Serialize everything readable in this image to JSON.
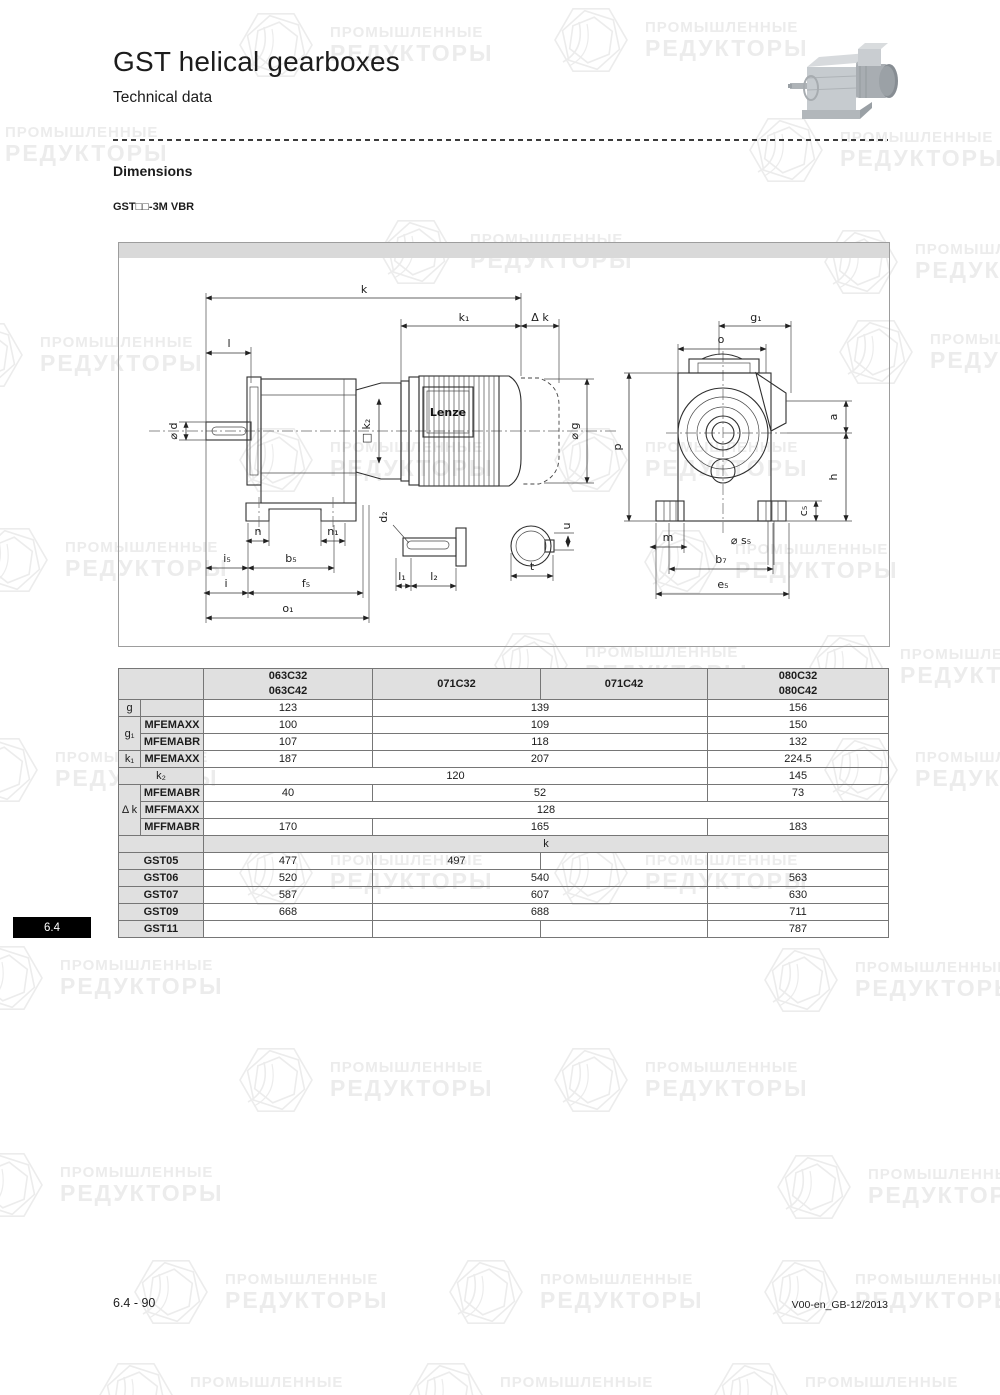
{
  "page": {
    "title": "GST helical gearboxes",
    "subtitle": "Technical data",
    "section_heading": "Dimensions",
    "variant_label": "GST□□-3M VBR",
    "tab_label": "6.4",
    "footer_left": "6.4 - 90",
    "footer_right": "V00-en_GB-12/2013"
  },
  "watermark": {
    "line1": "ПРОМЫШЛЕННЫЕ",
    "line2": "РЕДУКТОРЫ",
    "color": "#ececec"
  },
  "drawing": {
    "brand": "Lenze",
    "labels": {
      "k": "k",
      "k1": "k₁",
      "dk": "Δ k",
      "l": "l",
      "d": "⌀ d",
      "k2": "□ k₂",
      "g": "⌀ g",
      "n": "n",
      "n1": "n₁",
      "i5": "i₅",
      "b5": "b₅",
      "i": "i",
      "f5": "f₅",
      "o1": "o₁",
      "d2": "d₂",
      "l1": "l₁",
      "l2": "l₂",
      "t": "t",
      "u": "u",
      "g1": "g₁",
      "o": "o",
      "p": "p",
      "a": "a",
      "h": "h",
      "c5": "c₅",
      "m": "m",
      "s5": "⌀ s₅",
      "b7": "b₇",
      "e5": "e₅"
    }
  },
  "table": {
    "col_headers": {
      "c1a": "063C32",
      "c1b": "063C42",
      "c2": "071C32",
      "c3": "071C42",
      "c4a": "080C32",
      "c4b": "080C42"
    },
    "rows": {
      "g": {
        "label": "g",
        "sub": "",
        "v1": "123",
        "v23": "139",
        "v4": "156"
      },
      "g1": {
        "label": "g₁"
      },
      "g1_maxx": {
        "sub": "MFEMAXX",
        "v1": "100",
        "v23": "109",
        "v4": "150"
      },
      "g1_mabr": {
        "sub": "MFEMABR",
        "v1": "107",
        "v23": "118",
        "v4": "132"
      },
      "k1": {
        "label": "k₁",
        "sub": "MFEMAXX",
        "v1": "187",
        "v23": "207",
        "v4": "224.5"
      },
      "k2": {
        "label": "k₂",
        "v123": "120",
        "v4": "145"
      },
      "dk": {
        "label": "Δ k"
      },
      "dk_mabr": {
        "sub": "MFEMABR",
        "v1": "40",
        "v23": "52",
        "v4": "73"
      },
      "dk_fmaxx": {
        "sub": "MFFMAXX",
        "v1234": "128"
      },
      "dk_fmabr": {
        "sub": "MFFMABR",
        "v1": "170",
        "v23": "165",
        "v4": "183"
      },
      "k_section": {
        "label": "k"
      },
      "gst05": {
        "label": "GST05",
        "v1": "477",
        "v2": "497",
        "v3": "",
        "v4": ""
      },
      "gst06": {
        "label": "GST06",
        "v1": "520",
        "v23": "540",
        "v4": "563"
      },
      "gst07": {
        "label": "GST07",
        "v1": "587",
        "v23": "607",
        "v4": "630"
      },
      "gst09": {
        "label": "GST09",
        "v1": "668",
        "v23": "688",
        "v4": "711"
      },
      "gst11": {
        "label": "GST11",
        "v1": "",
        "v2": "",
        "v3": "",
        "v4": "787"
      }
    }
  }
}
